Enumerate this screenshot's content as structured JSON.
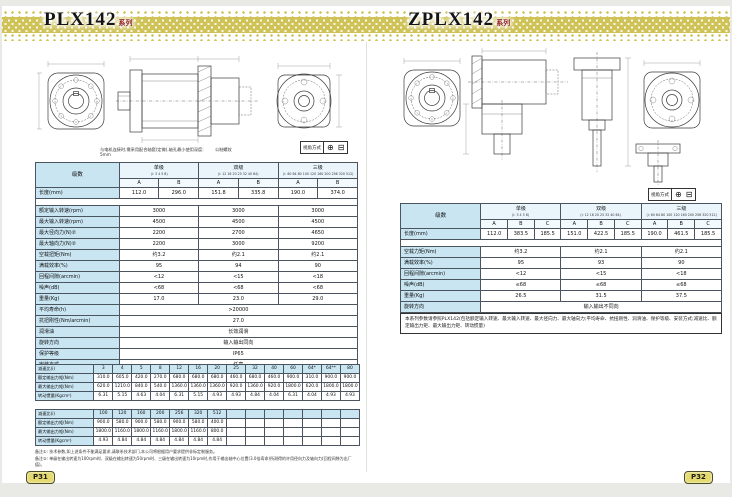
{
  "colors": {
    "accent": "#cfc257",
    "cell_blue": "#c9e5f2",
    "badge_yellow": "#e4da6e"
  },
  "left_page": {
    "title": "PLX142",
    "title_suffix": "系列",
    "drawing_note": "与电机连接时,需采用配合轴套(定做),轴孔最小使用深度: 5mm",
    "drawing_label": "公制螺纹",
    "view_box_label": "视角方式",
    "view_symbols": [
      "⊕",
      "⊟"
    ],
    "page_badge": "P31",
    "spec_table": {
      "corner": "级数",
      "groups": [
        {
          "name": "单级",
          "ratios": "(i: 3 4 5 8)"
        },
        {
          "name": "双级",
          "ratios": "(i: 12 16 20 25 32 40 64)"
        },
        {
          "name": "三级",
          "ratios": "(i: 60 64 80 100 120 160 200 256 320 512)"
        }
      ],
      "sub_cols": [
        "A",
        "B"
      ],
      "length_row": {
        "label": "长度(mm)",
        "values": [
          "112.0",
          "296.0",
          "151.8",
          "335.8",
          "190.0",
          "374.0"
        ]
      },
      "group_rows": [
        {
          "label": "额定输入转速(rpm)",
          "values": [
            "3000",
            "3000",
            "3000"
          ]
        },
        {
          "label": "最大输入转速(rpm)",
          "values": [
            "4500",
            "4500",
            "4500"
          ]
        },
        {
          "label": "最大径向力(N)②",
          "values": [
            "2200",
            "2700",
            "4650"
          ]
        },
        {
          "label": "最大轴向力(N)②",
          "values": [
            "2200",
            "3000",
            "9200"
          ]
        },
        {
          "label": "空载扭矩(Nm)",
          "values": [
            "约3.2",
            "约2.1",
            "约2.1"
          ]
        },
        {
          "label": "满载效率(%)",
          "values": [
            "95",
            "94",
            "90"
          ]
        },
        {
          "label": "回程间隙(arcmin)",
          "values": [
            "<12",
            "<15",
            "<18"
          ]
        },
        {
          "label": "噪声(dB)",
          "values": [
            "<68",
            "<68",
            "<68"
          ]
        },
        {
          "label": "重量(Kg)",
          "values": [
            "17.0",
            "23.0",
            "29.0"
          ]
        }
      ],
      "full_rows": [
        {
          "label": "平均寿命(h)",
          "value": ">20000"
        },
        {
          "label": "抗扭刚性(Nm/arcmin)",
          "value": "27.0"
        },
        {
          "label": "润滑油",
          "value": "长效润滑"
        },
        {
          "label": "旋转方向",
          "value": "输入输出同向"
        },
        {
          "label": "保护等级",
          "value": "IP65"
        },
        {
          "label": "安装方式",
          "value": "任意"
        }
      ]
    },
    "ratio_tables": [
      {
        "row_labels": [
          "减速比(i)",
          "额定输出力矩(Nm)",
          "最大输出力矩(Nm)",
          "转动惯量(Kgcm²)"
        ],
        "ratios": [
          "3",
          "4",
          "5",
          "8",
          "12",
          "16",
          "20",
          "25",
          "32",
          "40",
          "60",
          "64*",
          "64**",
          "80"
        ],
        "rated": [
          "310.0",
          "605.0",
          "420.0",
          "270.0",
          "680.0",
          "680.0",
          "680.0",
          "460.0",
          "680.0",
          "460.0",
          "900.0",
          "310.0",
          "900.0",
          "900.0"
        ],
        "max": [
          "620.0",
          "1210.0",
          "840.0",
          "540.0",
          "1360.0",
          "1360.0",
          "1360.0",
          "920.0",
          "1360.0",
          "920.0",
          "1800.0",
          "620.0",
          "1800.0",
          "1800.0"
        ],
        "inertia": [
          "6.31",
          "5.15",
          "4.63",
          "4.04",
          "6.31",
          "5.15",
          "4.93",
          "4.93",
          "4.84",
          "4.04",
          "6.31",
          "4.04",
          "4.93",
          "4.93"
        ]
      },
      {
        "row_labels": [
          "减速比(i)",
          "额定输出力矩(Nm)",
          "最大输出力矩(Nm)",
          "转动惯量(Kgcm²)"
        ],
        "ratios": [
          "100",
          "120",
          "160",
          "200",
          "256",
          "320",
          "512",
          "",
          "",
          "",
          "",
          "",
          "",
          ""
        ],
        "rated": [
          "900.0",
          "580.0",
          "900.0",
          "580.0",
          "900.0",
          "580.0",
          "400.0",
          "",
          "",
          "",
          "",
          "",
          "",
          ""
        ],
        "max": [
          "1800.0",
          "1160.0",
          "1800.0",
          "1160.0",
          "1800.0",
          "1160.0",
          "800.0",
          "",
          "",
          "",
          "",
          "",
          "",
          ""
        ],
        "inertia": [
          "4.93",
          "4.84",
          "4.84",
          "4.84",
          "4.84",
          "4.84",
          "4.84",
          "",
          "",
          "",
          "",
          "",
          "",
          ""
        ]
      }
    ],
    "footnotes": [
      "备注①: 技术参数,如上述条件不能满足要求,请联系技术部门,本公司将根据用户要求提供非标定制服务。",
      "备注②: 单级在输出转速为100rpm时、双级在输出转速为50rpm时、三级在输出转速为10rpm时,作用于输出轴中心位置(3.0倍寿命)所测得的许用径向力及轴向力(回程间隙为出厂值)。"
    ]
  },
  "right_page": {
    "title": "ZPLX142",
    "title_suffix": "系列",
    "view_box_label": "视角方式",
    "view_symbols": [
      "⊕",
      "⊟"
    ],
    "page_badge": "P32",
    "spec_table": {
      "corner": "级数",
      "groups": [
        {
          "name": "单级",
          "ratios": "(i: 3 4 5 8)"
        },
        {
          "name": "双级",
          "ratios": "(i: 12 16 20 25 32 40 64)"
        },
        {
          "name": "三级",
          "ratios": "(i: 60 64 80 100 120 160 200 256 320 512)"
        }
      ],
      "sub_cols": [
        "A",
        "B",
        "C"
      ],
      "length_row": {
        "label": "长度(mm)",
        "values": [
          "112.0",
          "383.5",
          "185.5",
          "151.0",
          "422.5",
          "185.5",
          "190.0",
          "461.5",
          "185.5"
        ]
      },
      "group_rows": [
        {
          "label": "空载力矩(Nm)",
          "values": [
            "约3.2",
            "约2.1",
            "约2.1"
          ]
        },
        {
          "label": "满载效率(%)",
          "values": [
            "95",
            "93",
            "90"
          ]
        },
        {
          "label": "回程间隙(arcmin)",
          "values": [
            "<12",
            "<15",
            "<18"
          ]
        },
        {
          "label": "噪声(dB)",
          "values": [
            "≤68",
            "≤68",
            "≤68"
          ]
        },
        {
          "label": "重量(Kg)",
          "values": [
            "26.5",
            "31.5",
            "37.5"
          ]
        }
      ],
      "full_rows": [
        {
          "label": "旋转方向",
          "value": "输入输出不同向"
        }
      ]
    },
    "note": "本系列参数请参照PLX142(包括额定输入转速、最大输入转速、最大径向力、最大轴向力;平均寿命、抗扭刚性、润滑油、保护等级、安装方式;减速比、额定输出力矩、最大输出力矩、转动惯量)"
  }
}
